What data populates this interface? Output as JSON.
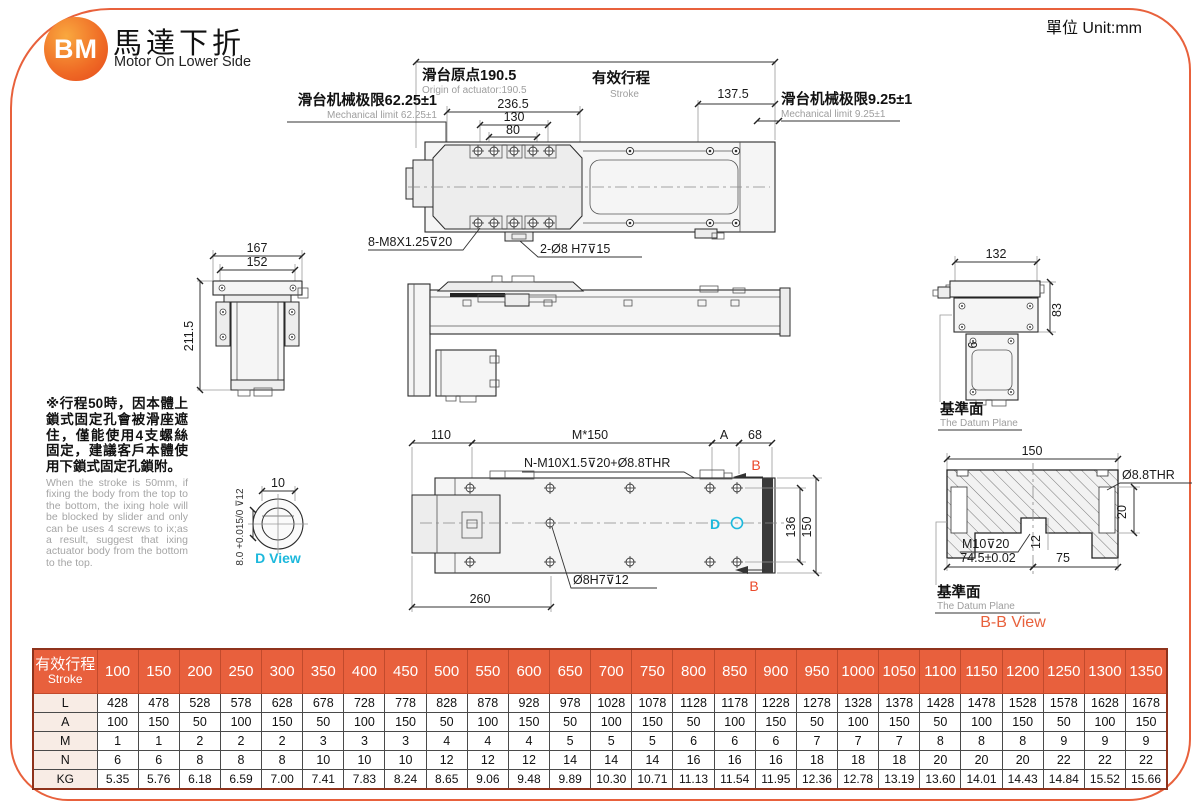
{
  "page": {
    "unit_label": "單位 Unit:mm"
  },
  "header": {
    "logo_text": "BM",
    "title_zh": "馬達下折",
    "title_en": "Motor On Lower Side"
  },
  "colors": {
    "accent": "#E8613C",
    "cyan": "#1CB8DC",
    "red_label": "#EB4A2B",
    "table_header": "#E8603D"
  },
  "top_view": {
    "origin_zh": "滑台原点190.5",
    "origin_en": "Origin of actuator:190.5",
    "stroke_zh": "有效行程",
    "stroke_en": "Stroke",
    "dim_right": "137.5",
    "limit_left_zh": "滑台机械极限62.25±1",
    "limit_left_en": "Mechanical limit 62.25±1",
    "limit_right_zh": "滑台机械极限9.25±1",
    "limit_right_en": "Mechanical limit 9.25±1",
    "dim_236_5": "236.5",
    "dim_130": "130",
    "dim_80": "80",
    "label_screws": "8-M8X1.25⊽20",
    "label_dowel": "2-Ø8 H7⊽15"
  },
  "left_view": {
    "dim_width_outer": "167",
    "dim_width_inner": "152",
    "dim_height": "211.5"
  },
  "right_view": {
    "dim_width": "132",
    "dim_height": "83",
    "dim_offset": "6",
    "datum_zh": "基準面",
    "datum_en": "The Datum Plane"
  },
  "bottom_view": {
    "dim_110": "110",
    "dim_pitch": "M*150",
    "dim_a": "A",
    "dim_68": "68",
    "label_holes": "N-M10X1.5⊽20+Ø8.8THR",
    "label_b": "B",
    "label_d": "D",
    "dim_136": "136",
    "dim_150": "150",
    "label_pin": "Ø8H7⊽12",
    "dim_260": "260"
  },
  "d_view": {
    "dim_10": "10",
    "tol": "8.0 +0.015/0 ⊽12",
    "label": "D View"
  },
  "bb_view": {
    "dim_150": "150",
    "label_thr": "Ø8.8THR",
    "dim_20": "20",
    "dim_12": "12",
    "label_tap": "M10⊽20",
    "dim_74_5": "74.5±0.02",
    "dim_75": "75",
    "datum_zh": "基準面",
    "datum_en": "The Datum Plane",
    "label": "B-B View"
  },
  "note": {
    "zh": "※行程50時，因本體上鎖式固定孔會被滑座遮住，僅能使用4支螺絲固定，建議客戶本體使用下鎖式固定孔鎖附。",
    "en": "When the stroke is 50mm, if fixing the body from the top to the bottom, the ixing hole will be blocked by slider and only can be uses 4 screws to ix;as a result, suggest that ixing actuator body from the bottom to the top."
  },
  "table": {
    "header_zh": "有效行程",
    "header_en": "Stroke",
    "strokes": [
      100,
      150,
      200,
      250,
      300,
      350,
      400,
      450,
      500,
      550,
      600,
      650,
      700,
      750,
      800,
      850,
      900,
      950,
      1000,
      1050,
      1100,
      1150,
      1200,
      1250,
      1300,
      1350
    ],
    "rows": [
      {
        "label": "L",
        "values": [
          428,
          478,
          528,
          578,
          628,
          678,
          728,
          778,
          828,
          878,
          928,
          978,
          1028,
          1078,
          1128,
          1178,
          1228,
          1278,
          1328,
          1378,
          1428,
          1478,
          1528,
          1578,
          1628,
          1678
        ]
      },
      {
        "label": "A",
        "values": [
          100,
          150,
          50,
          100,
          150,
          50,
          100,
          150,
          50,
          100,
          150,
          50,
          100,
          150,
          50,
          100,
          150,
          50,
          100,
          150,
          50,
          100,
          150,
          50,
          100,
          150
        ]
      },
      {
        "label": "M",
        "values": [
          1,
          1,
          2,
          2,
          2,
          3,
          3,
          3,
          4,
          4,
          4,
          5,
          5,
          5,
          6,
          6,
          6,
          7,
          7,
          7,
          8,
          8,
          8,
          9,
          9,
          9
        ]
      },
      {
        "label": "N",
        "values": [
          6,
          6,
          8,
          8,
          8,
          10,
          10,
          10,
          12,
          12,
          12,
          14,
          14,
          14,
          16,
          16,
          16,
          18,
          18,
          18,
          20,
          20,
          20,
          22,
          22,
          22
        ]
      },
      {
        "label": "KG",
        "values": [
          "5.35",
          "5.76",
          "6.18",
          "6.59",
          "7.00",
          "7.41",
          "7.83",
          "8.24",
          "8.65",
          "9.06",
          "9.48",
          "9.89",
          "10.30",
          "10.71",
          "11.13",
          "11.54",
          "11.95",
          "12.36",
          "12.78",
          "13.19",
          "13.60",
          "14.01",
          "14.43",
          "14.84",
          "15.52",
          "15.66"
        ]
      }
    ]
  }
}
